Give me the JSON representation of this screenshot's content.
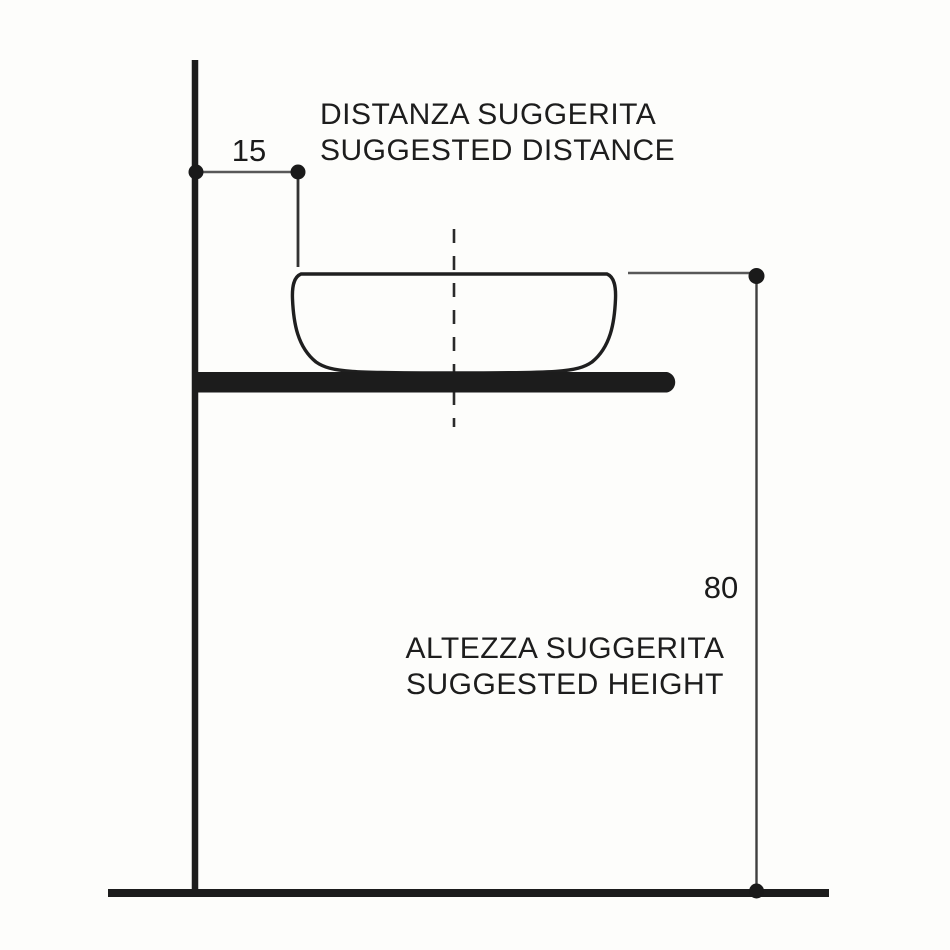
{
  "diagram": {
    "title": "washbasin-installation-dimensions",
    "distance_dimension": {
      "value": "15",
      "label_it": "DISTANZA SUGGERITA",
      "label_en": "SUGGESTED DISTANCE"
    },
    "height_dimension": {
      "value": "80",
      "label_it": "ALTEZZA SUGGERITA",
      "label_en": "SUGGESTED HEIGHT"
    },
    "colors": {
      "background": "#fdfdfb",
      "outline": "#1e1e1e",
      "dimension_line": "#585858",
      "text": "#1d1d1d"
    }
  }
}
